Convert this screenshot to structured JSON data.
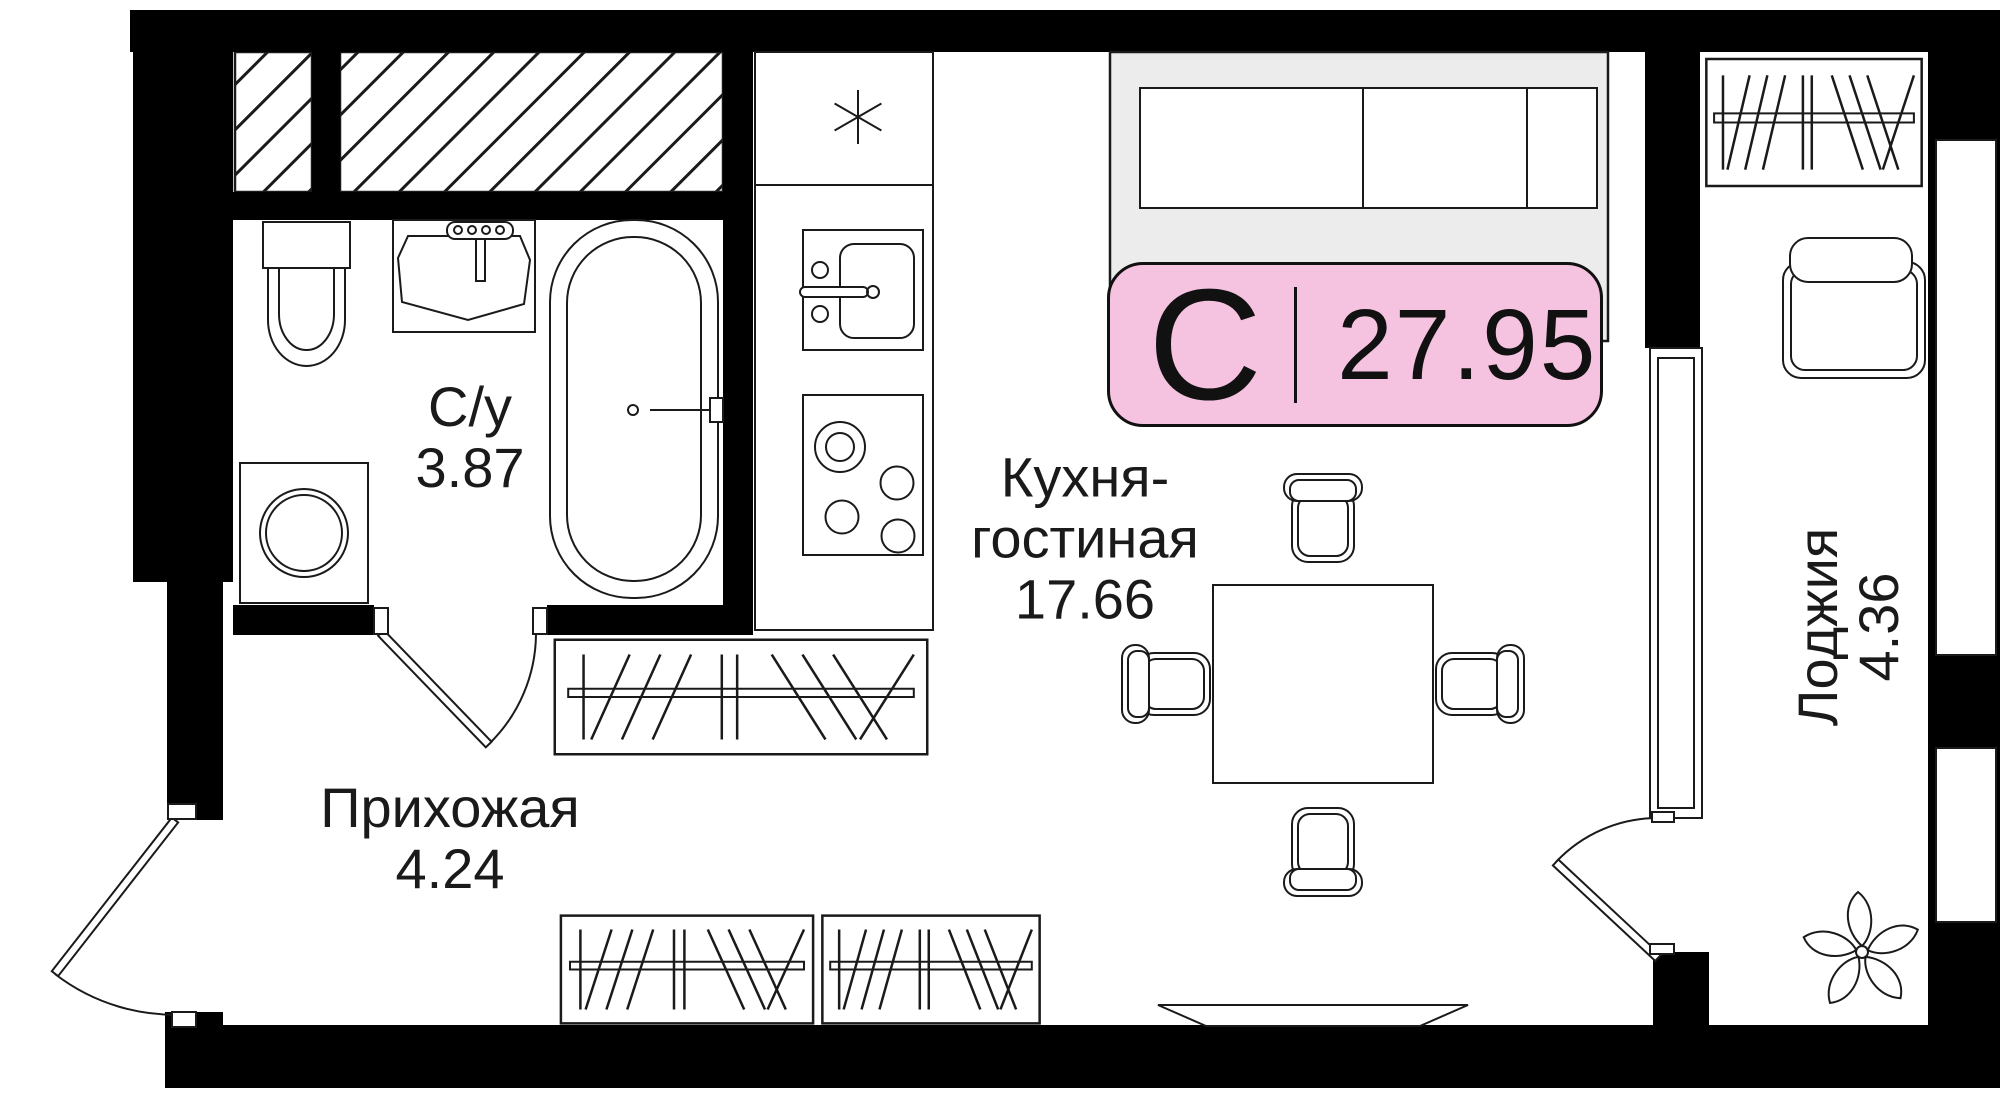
{
  "unit_card": {
    "type_letter": "С",
    "area_value": "27.95"
  },
  "rooms": {
    "bathroom": {
      "label": "С/у",
      "area": "3.87"
    },
    "kitchen_living": {
      "label_line1": "Кухня-",
      "label_line2": "гостиная",
      "area": "17.66"
    },
    "hallway": {
      "label": "Прихожая",
      "area": "4.24"
    },
    "loggia": {
      "label": "Лоджия",
      "area": "4.36"
    }
  },
  "colors": {
    "wall": "#000000",
    "line": "#1a1a1a",
    "badge_fill": "#f5c3e0",
    "badge_border": "#111111",
    "sofa_fill": "#ececec",
    "paper": "#ffffff"
  },
  "icons": {
    "freezer_star": "six-spoke-asterisk",
    "wardrobe_rod": "rod-with-hangers",
    "shelf_hatch": "diagonal-hatch"
  }
}
